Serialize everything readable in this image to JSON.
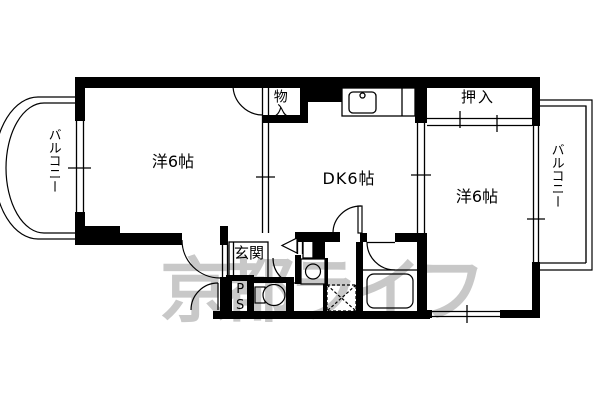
{
  "floorplan": {
    "type": "apartment-floorplan",
    "background": "#ffffff",
    "wall_color": "#000000",
    "labels": {
      "left_room": "洋6帖",
      "dk": "DK6帖",
      "right_room": "洋6帖",
      "oshiire": "押入",
      "monoire": "物入",
      "genkan": "玄関",
      "ps": "PS",
      "balcony_left": "バルコニー",
      "balcony_right": "バルコニー"
    },
    "watermark": {
      "text": "京都ライフ",
      "color": "#c8c8c8"
    }
  }
}
